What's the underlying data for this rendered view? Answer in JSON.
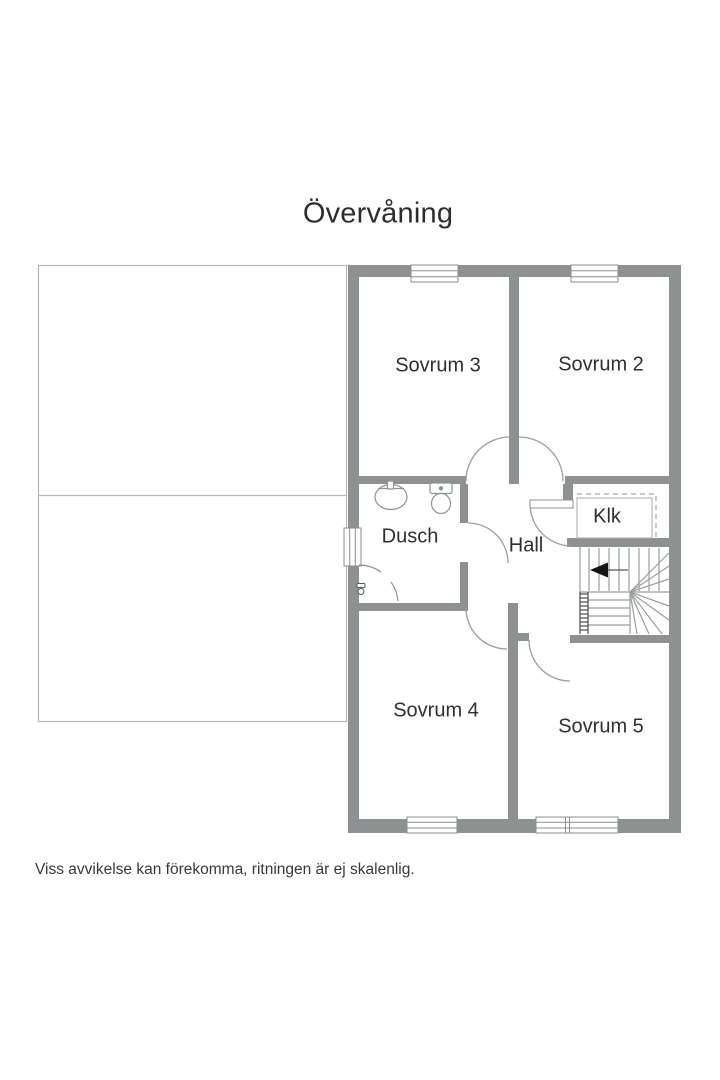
{
  "title": "Övervåning",
  "rooms": {
    "sovrum3": {
      "label": "Sovrum 3"
    },
    "sovrum2": {
      "label": "Sovrum 2"
    },
    "dusch": {
      "label": "Dusch"
    },
    "hall": {
      "label": "Hall"
    },
    "klk": {
      "label": "Klk"
    },
    "sovrum4": {
      "label": "Sovrum 4"
    },
    "sovrum5": {
      "label": "Sovrum 5"
    }
  },
  "disclaimer": "Viss avvikelse kan förekomma, ritningen är ej skalenlig.",
  "icons": {
    "sink": "sink-icon",
    "toilet": "toilet-icon",
    "shower_mixer": "shower-mixer-icon",
    "stairs_direction": "arrow-left-icon"
  },
  "colors": {
    "wall": "#8d9192",
    "fixture_line": "#8f9394",
    "stair_line": "#9a9e9f",
    "attic_outline": "#b4b7b8",
    "hatch": "#3c3c3c",
    "text": "#2d2f31",
    "background": "#ffffff"
  }
}
